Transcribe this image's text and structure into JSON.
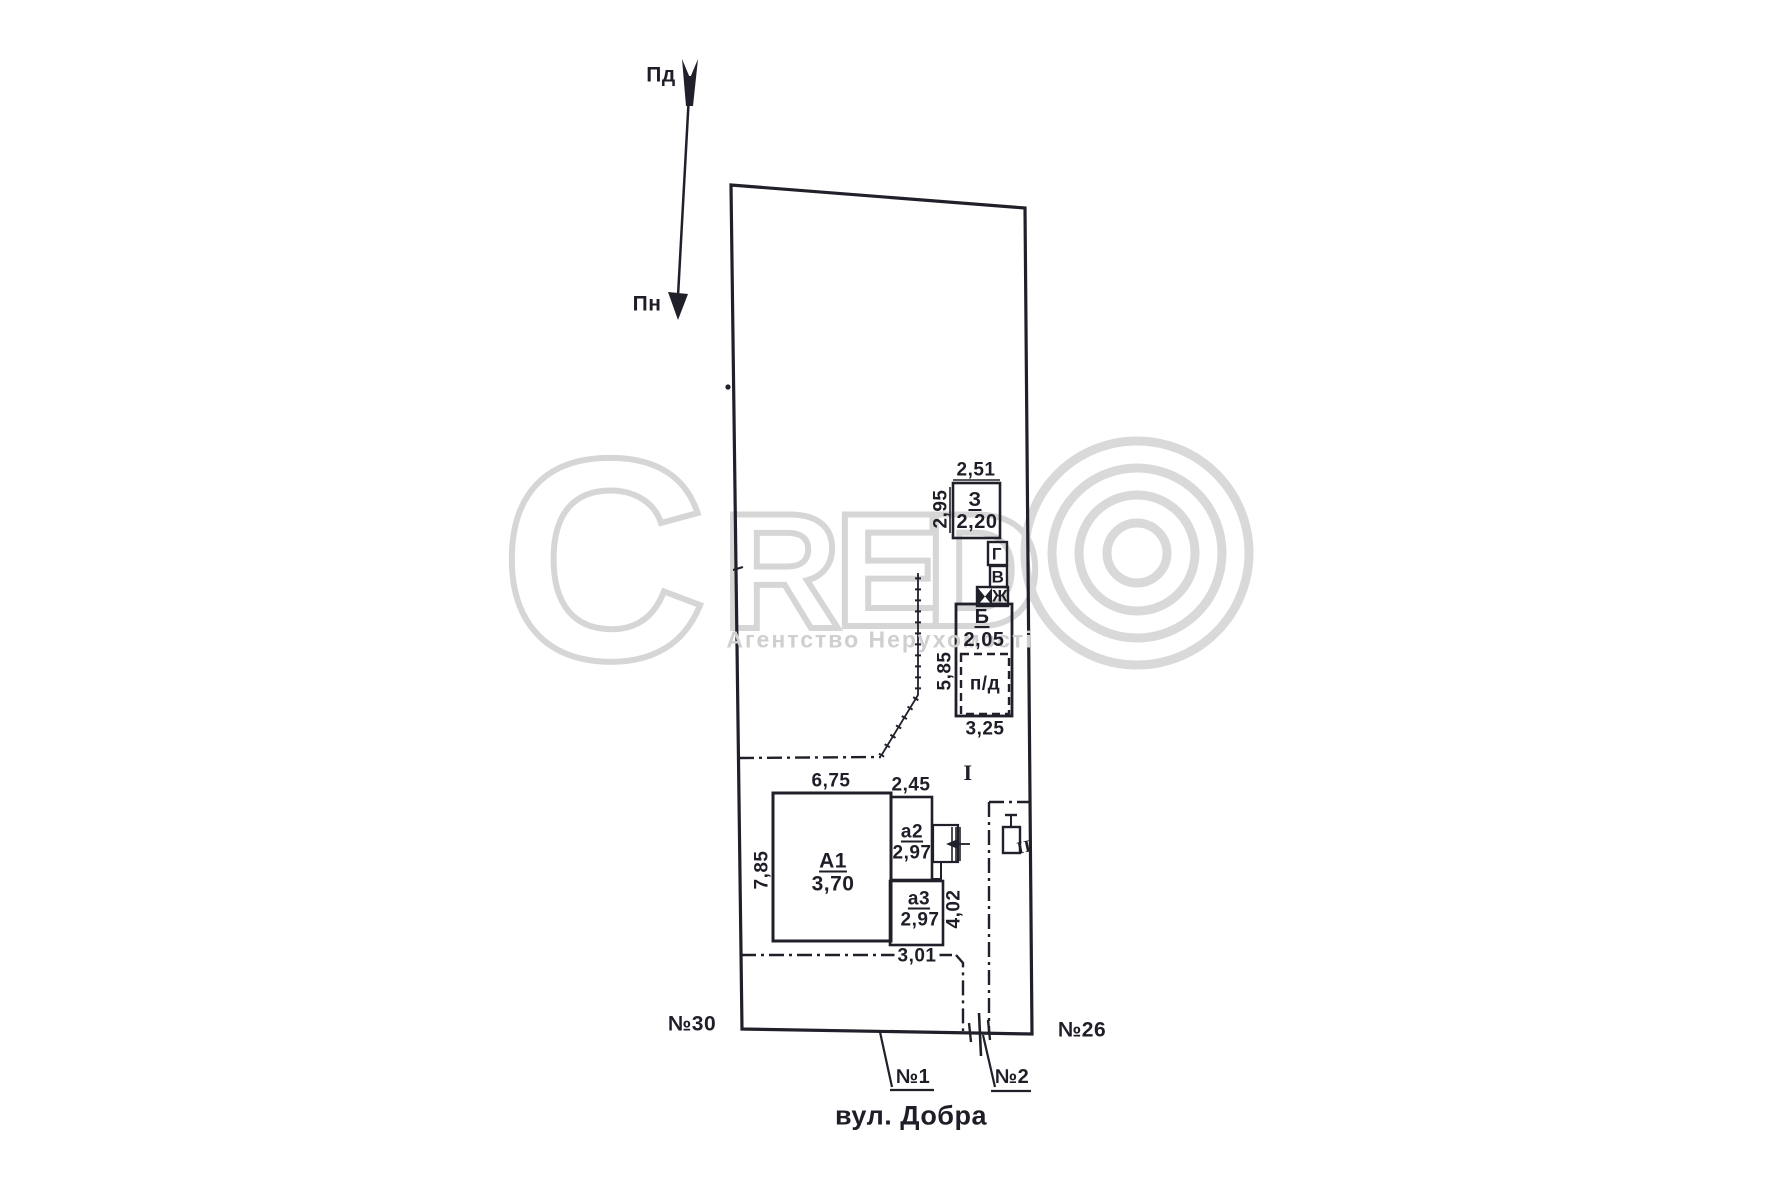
{
  "compass": {
    "south": "Пд",
    "north": "Пн"
  },
  "watermark": {
    "c": "C",
    "r": "R",
    "e": "E",
    "d": "D",
    "subtitle": "Агентство Нерухомості",
    "letter_color": "#d6d6d6",
    "subtitle_color": "#cfcfcf"
  },
  "buildings": {
    "z": {
      "label": "З",
      "height": "2,20"
    },
    "g": {
      "label": "Г"
    },
    "v": {
      "label": "В"
    },
    "zh": {
      "label": "Ж"
    },
    "b": {
      "label": "Б",
      "height": "2,05"
    },
    "pd": {
      "label": "п/д"
    },
    "a1": {
      "label": "А1",
      "height": "3,70"
    },
    "a2": {
      "label": "а2",
      "height": "2,97"
    },
    "a3": {
      "label": "а3",
      "height": "2,97"
    }
  },
  "dimensions": {
    "z_top": "2,51",
    "z_left": "2,95",
    "b_left": "5,85",
    "b_bottom": "3,25",
    "a1_top": "6,75",
    "a2_top": "2,45",
    "a1_left": "7,85",
    "a3_right": "4,02",
    "a3_bottom": "3,01"
  },
  "zones": {
    "yard": "I",
    "corridor": "II"
  },
  "labels": {
    "neighbor_left": "№30",
    "neighbor_right": "№26",
    "gate1": "№1",
    "gate2": "№2",
    "street": "вул. Добра"
  },
  "ink_color": "#20202a"
}
